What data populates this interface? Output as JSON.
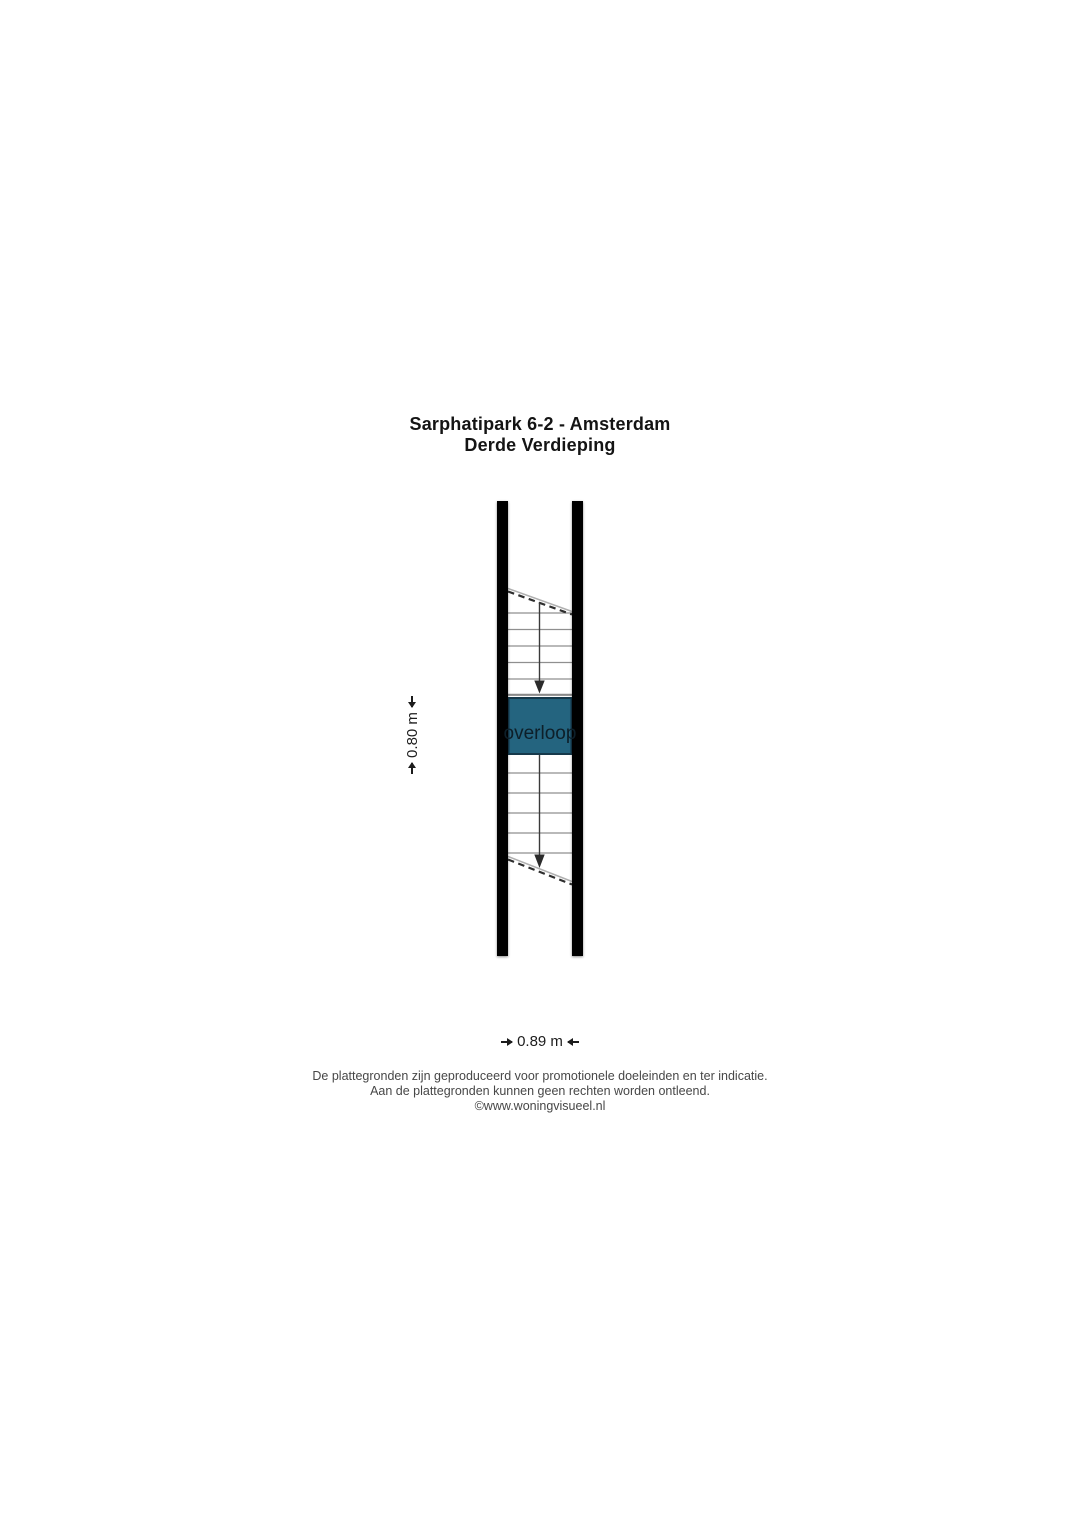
{
  "page": {
    "background": "#ffffff"
  },
  "title": {
    "line1": "Sarphatipark 6-2 - Amsterdam",
    "line2": "Derde Verdieping"
  },
  "floorplan": {
    "room": {
      "label": "overloop",
      "fill": "#24647f",
      "border": "#16394b"
    },
    "wall_color": "#000000",
    "dimensions": {
      "width_label": "0.89 m",
      "height_label": "0.80 m"
    }
  },
  "footer": {
    "line1": "De plattegronden zijn geproduceerd voor promotionele doeleinden en ter indicatie.",
    "line2": "Aan de plattegronden kunnen geen rechten worden ontleend.",
    "line3": "©www.woningvisueel.nl"
  }
}
